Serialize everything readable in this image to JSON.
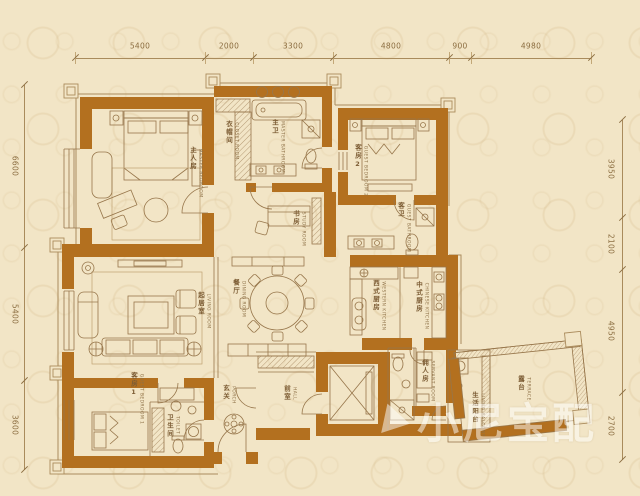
{
  "watermark": {
    "text": "小尼宝配"
  },
  "dimensions": {
    "top": [
      "5400",
      "2000",
      "3300",
      "4800",
      "900",
      "4980"
    ],
    "left": [
      "6600",
      "5400",
      "3600"
    ],
    "right": [
      "3950",
      "2100",
      "4950",
      "2700"
    ]
  },
  "rooms": [
    {
      "id": "master-bedroom",
      "zh": "主人房",
      "en": "MASTER BEDROOM"
    },
    {
      "id": "closet-room",
      "zh": "衣帽间",
      "en": "CLOSET ROOM"
    },
    {
      "id": "master-bathroom",
      "zh": "主卫",
      "en": "MASTER BATHROOM"
    },
    {
      "id": "study-room",
      "zh": "书房",
      "en": "STUDY ROOM"
    },
    {
      "id": "guest-bedroom-2",
      "zh": "客房2",
      "en": "GUEST BEDROOM 2"
    },
    {
      "id": "guest-bathroom",
      "zh": "客卫",
      "en": "GUEST BATHROOM"
    },
    {
      "id": "living-room",
      "zh": "起居室",
      "en": "LIVING ROOM"
    },
    {
      "id": "dining-room",
      "zh": "餐厅",
      "en": "DINING ROOM"
    },
    {
      "id": "western-kitchen",
      "zh": "西式厨房",
      "en": "WESTERN KITCHEN"
    },
    {
      "id": "chinese-kitchen",
      "zh": "中式厨房",
      "en": "CHINESE KITCHEN"
    },
    {
      "id": "guest-bedroom-1",
      "zh": "客房1",
      "en": "GUEST BEDROOM 1"
    },
    {
      "id": "toilet",
      "zh": "卫生间",
      "en": "TOILET"
    },
    {
      "id": "porch",
      "zh": "玄关",
      "en": "PORCH"
    },
    {
      "id": "hall",
      "zh": "前室",
      "en": "HALL"
    },
    {
      "id": "servant-room",
      "zh": "佣人房",
      "en": "SERVANT ROOM"
    },
    {
      "id": "living-balcony",
      "zh": "生活阳台",
      "en": "LIVING BALCONY"
    },
    {
      "id": "terrace",
      "zh": "露台",
      "en": "TERRACE"
    }
  ],
  "colors": {
    "wall": "#b3701f",
    "background": "#f2e5c6",
    "line": "#97764b",
    "watermark": "#ffffff"
  }
}
